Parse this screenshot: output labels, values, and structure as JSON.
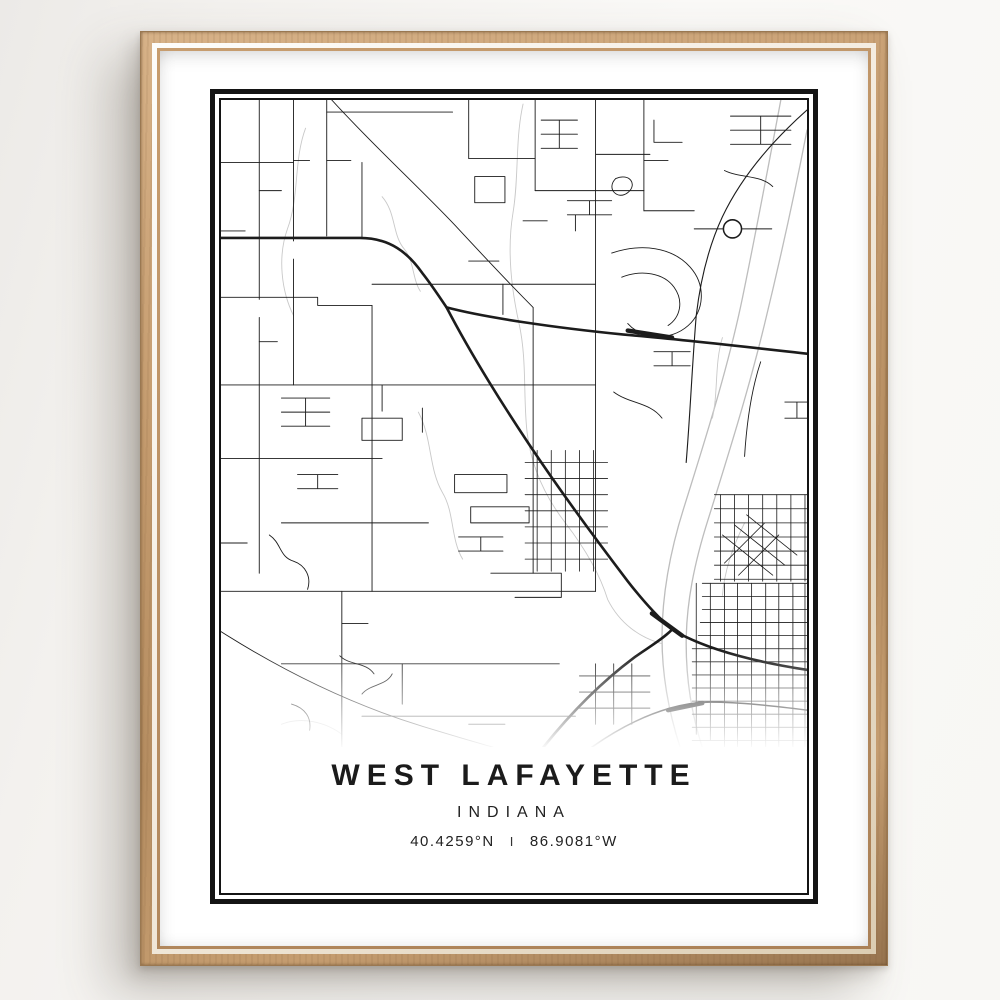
{
  "poster": {
    "title": "WEST LAFAYETTE",
    "state": "INDIANA",
    "coordinates": {
      "latitude": "40.4259°N",
      "separator": "I",
      "longitude": "86.9081°W"
    }
  },
  "colors": {
    "background": "#f7f6f3",
    "frame_wood": "#c39a6d",
    "frame_wood_dark": "#97744f",
    "frame_highlight": "#f4ece0",
    "mat": "#ffffff",
    "poster_border": "#141414",
    "road": "#1c1c1c",
    "water": "#bdbdbd"
  }
}
